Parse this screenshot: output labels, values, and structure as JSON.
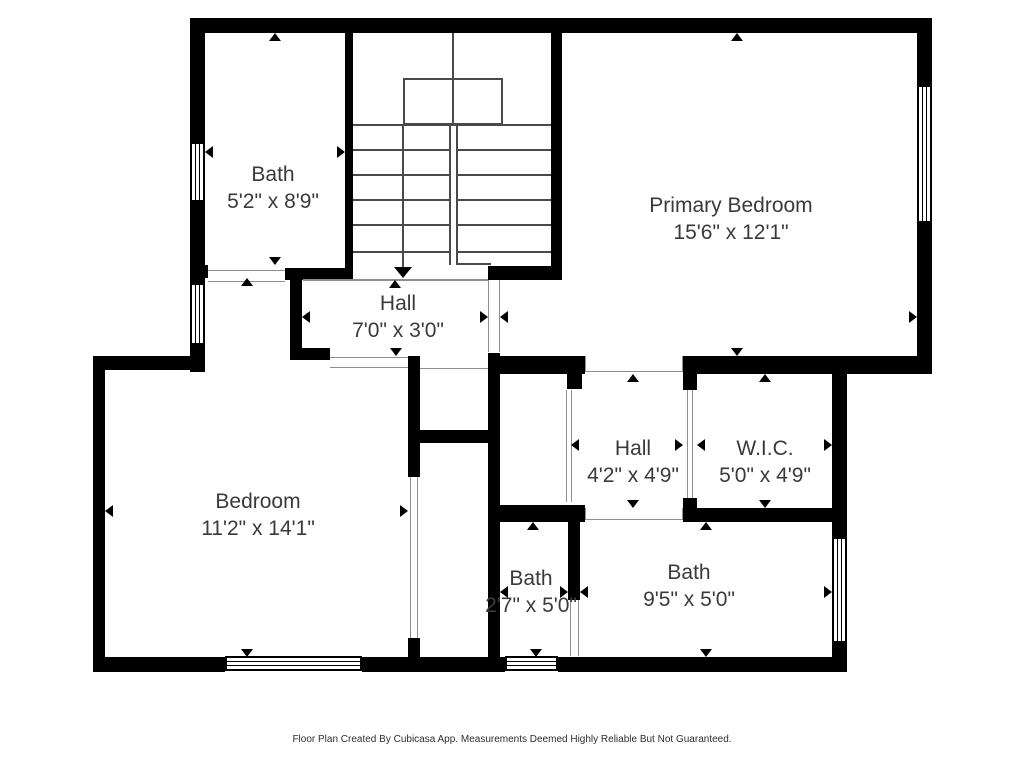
{
  "page": {
    "footer": "Floor Plan Created By Cubicasa App. Measurements Deemed Highly Reliable But Not Guaranteed.",
    "background": "#ffffff"
  },
  "colors": {
    "wall": "#000000",
    "label_text": "#3a3a3a",
    "stair_line": "#4a4a4a",
    "threshold_line": "#8f8f8f"
  },
  "rooms": [
    {
      "name": "Bath",
      "dims": "5'2\" x 8'9\"",
      "cx": 273,
      "cy": 188
    },
    {
      "name": "Primary Bedroom",
      "dims": "15'6\" x 12'1\"",
      "cx": 731,
      "cy": 219
    },
    {
      "name": "Hall",
      "dims": "7'0\" x 3'0\"",
      "cx": 398,
      "cy": 317
    },
    {
      "name": "Bedroom",
      "dims": "11'2\" x 14'1\"",
      "cx": 258,
      "cy": 515
    },
    {
      "name": "Hall",
      "dims": "4'2\" x 4'9\"",
      "cx": 633,
      "cy": 462
    },
    {
      "name": "W.I.C.",
      "dims": "5'0\" x 4'9\"",
      "cx": 765,
      "cy": 462
    },
    {
      "name": "Bath",
      "dims": "2'7\" x 5'0\"",
      "cx": 531,
      "cy": 592
    },
    {
      "name": "Bath",
      "dims": "9'5\" x 5'0\"",
      "cx": 689,
      "cy": 586
    }
  ],
  "geometry": {
    "walls": [
      [
        190,
        18,
        742,
        15
      ],
      [
        190,
        33,
        15,
        109
      ],
      [
        190,
        202,
        15,
        81
      ],
      [
        190,
        345,
        15,
        27
      ],
      [
        917,
        33,
        15,
        52
      ],
      [
        917,
        223,
        15,
        151
      ],
      [
        93,
        356,
        12,
        316
      ],
      [
        93,
        657,
        132,
        15
      ],
      [
        362,
        657,
        143,
        15
      ],
      [
        558,
        657,
        289,
        15
      ],
      [
        832,
        374,
        15,
        163
      ],
      [
        832,
        643,
        15,
        29
      ],
      [
        345,
        33,
        8,
        245
      ],
      [
        190,
        265,
        18,
        13
      ],
      [
        285,
        268,
        68,
        12
      ],
      [
        290,
        280,
        12,
        68
      ],
      [
        290,
        348,
        40,
        12
      ],
      [
        488,
        266,
        74,
        14
      ],
      [
        551,
        33,
        11,
        247
      ],
      [
        93,
        356,
        112,
        14
      ],
      [
        408,
        356,
        12,
        121
      ],
      [
        408,
        638,
        12,
        19
      ],
      [
        420,
        430,
        68,
        13
      ],
      [
        488,
        353,
        12,
        304
      ],
      [
        488,
        356,
        97,
        18
      ],
      [
        683,
        356,
        249,
        18
      ],
      [
        567,
        374,
        15,
        15
      ],
      [
        683,
        374,
        14,
        16
      ],
      [
        683,
        498,
        14,
        24
      ],
      [
        683,
        508,
        164,
        14
      ],
      [
        500,
        505,
        85,
        17
      ],
      [
        568,
        505,
        12,
        95
      ]
    ],
    "windows": [
      [
        190,
        142,
        15,
        60,
        "v"
      ],
      [
        190,
        283,
        15,
        62,
        "v"
      ],
      [
        917,
        85,
        15,
        138,
        "v"
      ],
      [
        832,
        537,
        15,
        106,
        "v"
      ],
      [
        225,
        656,
        137,
        15,
        "h"
      ],
      [
        505,
        656,
        53,
        15,
        "h"
      ]
    ],
    "stair_lines": [
      [
        353,
        124,
        198,
        2
      ],
      [
        353,
        149,
        198,
        2
      ],
      [
        353,
        174,
        198,
        2
      ],
      [
        353,
        199,
        198,
        2
      ],
      [
        353,
        224,
        198,
        2
      ],
      [
        353,
        251,
        198,
        2
      ],
      [
        452,
        33,
        2,
        92
      ],
      [
        402,
        124,
        2,
        146
      ],
      [
        449,
        263,
        42,
        2
      ]
    ],
    "stair_whites": [
      [
        451,
        126,
        6,
        139
      ]
    ],
    "stair_rails": [
      [
        449,
        124,
        2,
        141
      ],
      [
        456,
        124,
        2,
        141
      ]
    ],
    "boxes": [
      [
        403,
        78,
        100,
        47
      ]
    ],
    "hairlines": [
      [
        208,
        270,
        77,
        1
      ],
      [
        208,
        281,
        77,
        1
      ],
      [
        488,
        280,
        1,
        72
      ],
      [
        499,
        280,
        1,
        72
      ],
      [
        330,
        357,
        78,
        1
      ],
      [
        330,
        367,
        78,
        1
      ],
      [
        420,
        368,
        68,
        1
      ],
      [
        410,
        477,
        1,
        161
      ],
      [
        417,
        477,
        1,
        161
      ],
      [
        585,
        371,
        97,
        1
      ],
      [
        585,
        356,
        1,
        16
      ],
      [
        682,
        356,
        1,
        16
      ],
      [
        566,
        390,
        1,
        112
      ],
      [
        571,
        390,
        1,
        112
      ],
      [
        687,
        390,
        1,
        108
      ],
      [
        692,
        390,
        1,
        108
      ],
      [
        585,
        519,
        97,
        1
      ],
      [
        585,
        508,
        1,
        12
      ],
      [
        682,
        508,
        1,
        12
      ],
      [
        570,
        600,
        1,
        56
      ],
      [
        578,
        600,
        1,
        56
      ],
      [
        303,
        279,
        185,
        2
      ]
    ],
    "arrows": [
      [
        275,
        33,
        "up",
        0
      ],
      [
        275,
        265,
        "down",
        0
      ],
      [
        205,
        152,
        "left",
        0
      ],
      [
        345,
        152,
        "right",
        0
      ],
      [
        737,
        33,
        "up",
        0
      ],
      [
        737,
        356,
        "down",
        0
      ],
      [
        500,
        317,
        "left",
        0
      ],
      [
        917,
        317,
        "right",
        0
      ],
      [
        395,
        280,
        "up",
        0
      ],
      [
        396,
        356,
        "down",
        0
      ],
      [
        302,
        317,
        "left",
        0
      ],
      [
        488,
        317,
        "right",
        0
      ],
      [
        403,
        278,
        "down",
        1
      ],
      [
        247,
        278,
        "up",
        0
      ],
      [
        247,
        657,
        "down",
        0
      ],
      [
        105,
        511,
        "left",
        0
      ],
      [
        408,
        511,
        "right",
        0
      ],
      [
        633,
        374,
        "up",
        0
      ],
      [
        633,
        508,
        "down",
        0
      ],
      [
        571,
        445,
        "left",
        0
      ],
      [
        683,
        445,
        "right",
        0
      ],
      [
        765,
        374,
        "up",
        0
      ],
      [
        765,
        508,
        "down",
        0
      ],
      [
        697,
        445,
        "left",
        0
      ],
      [
        832,
        445,
        "right",
        0
      ],
      [
        533,
        522,
        "up",
        0
      ],
      [
        536,
        657,
        "down",
        0
      ],
      [
        500,
        592,
        "left",
        0
      ],
      [
        568,
        592,
        "right",
        0
      ],
      [
        706,
        522,
        "up",
        0
      ],
      [
        706,
        657,
        "down",
        0
      ],
      [
        580,
        592,
        "left",
        0
      ],
      [
        832,
        592,
        "right",
        0
      ]
    ]
  }
}
